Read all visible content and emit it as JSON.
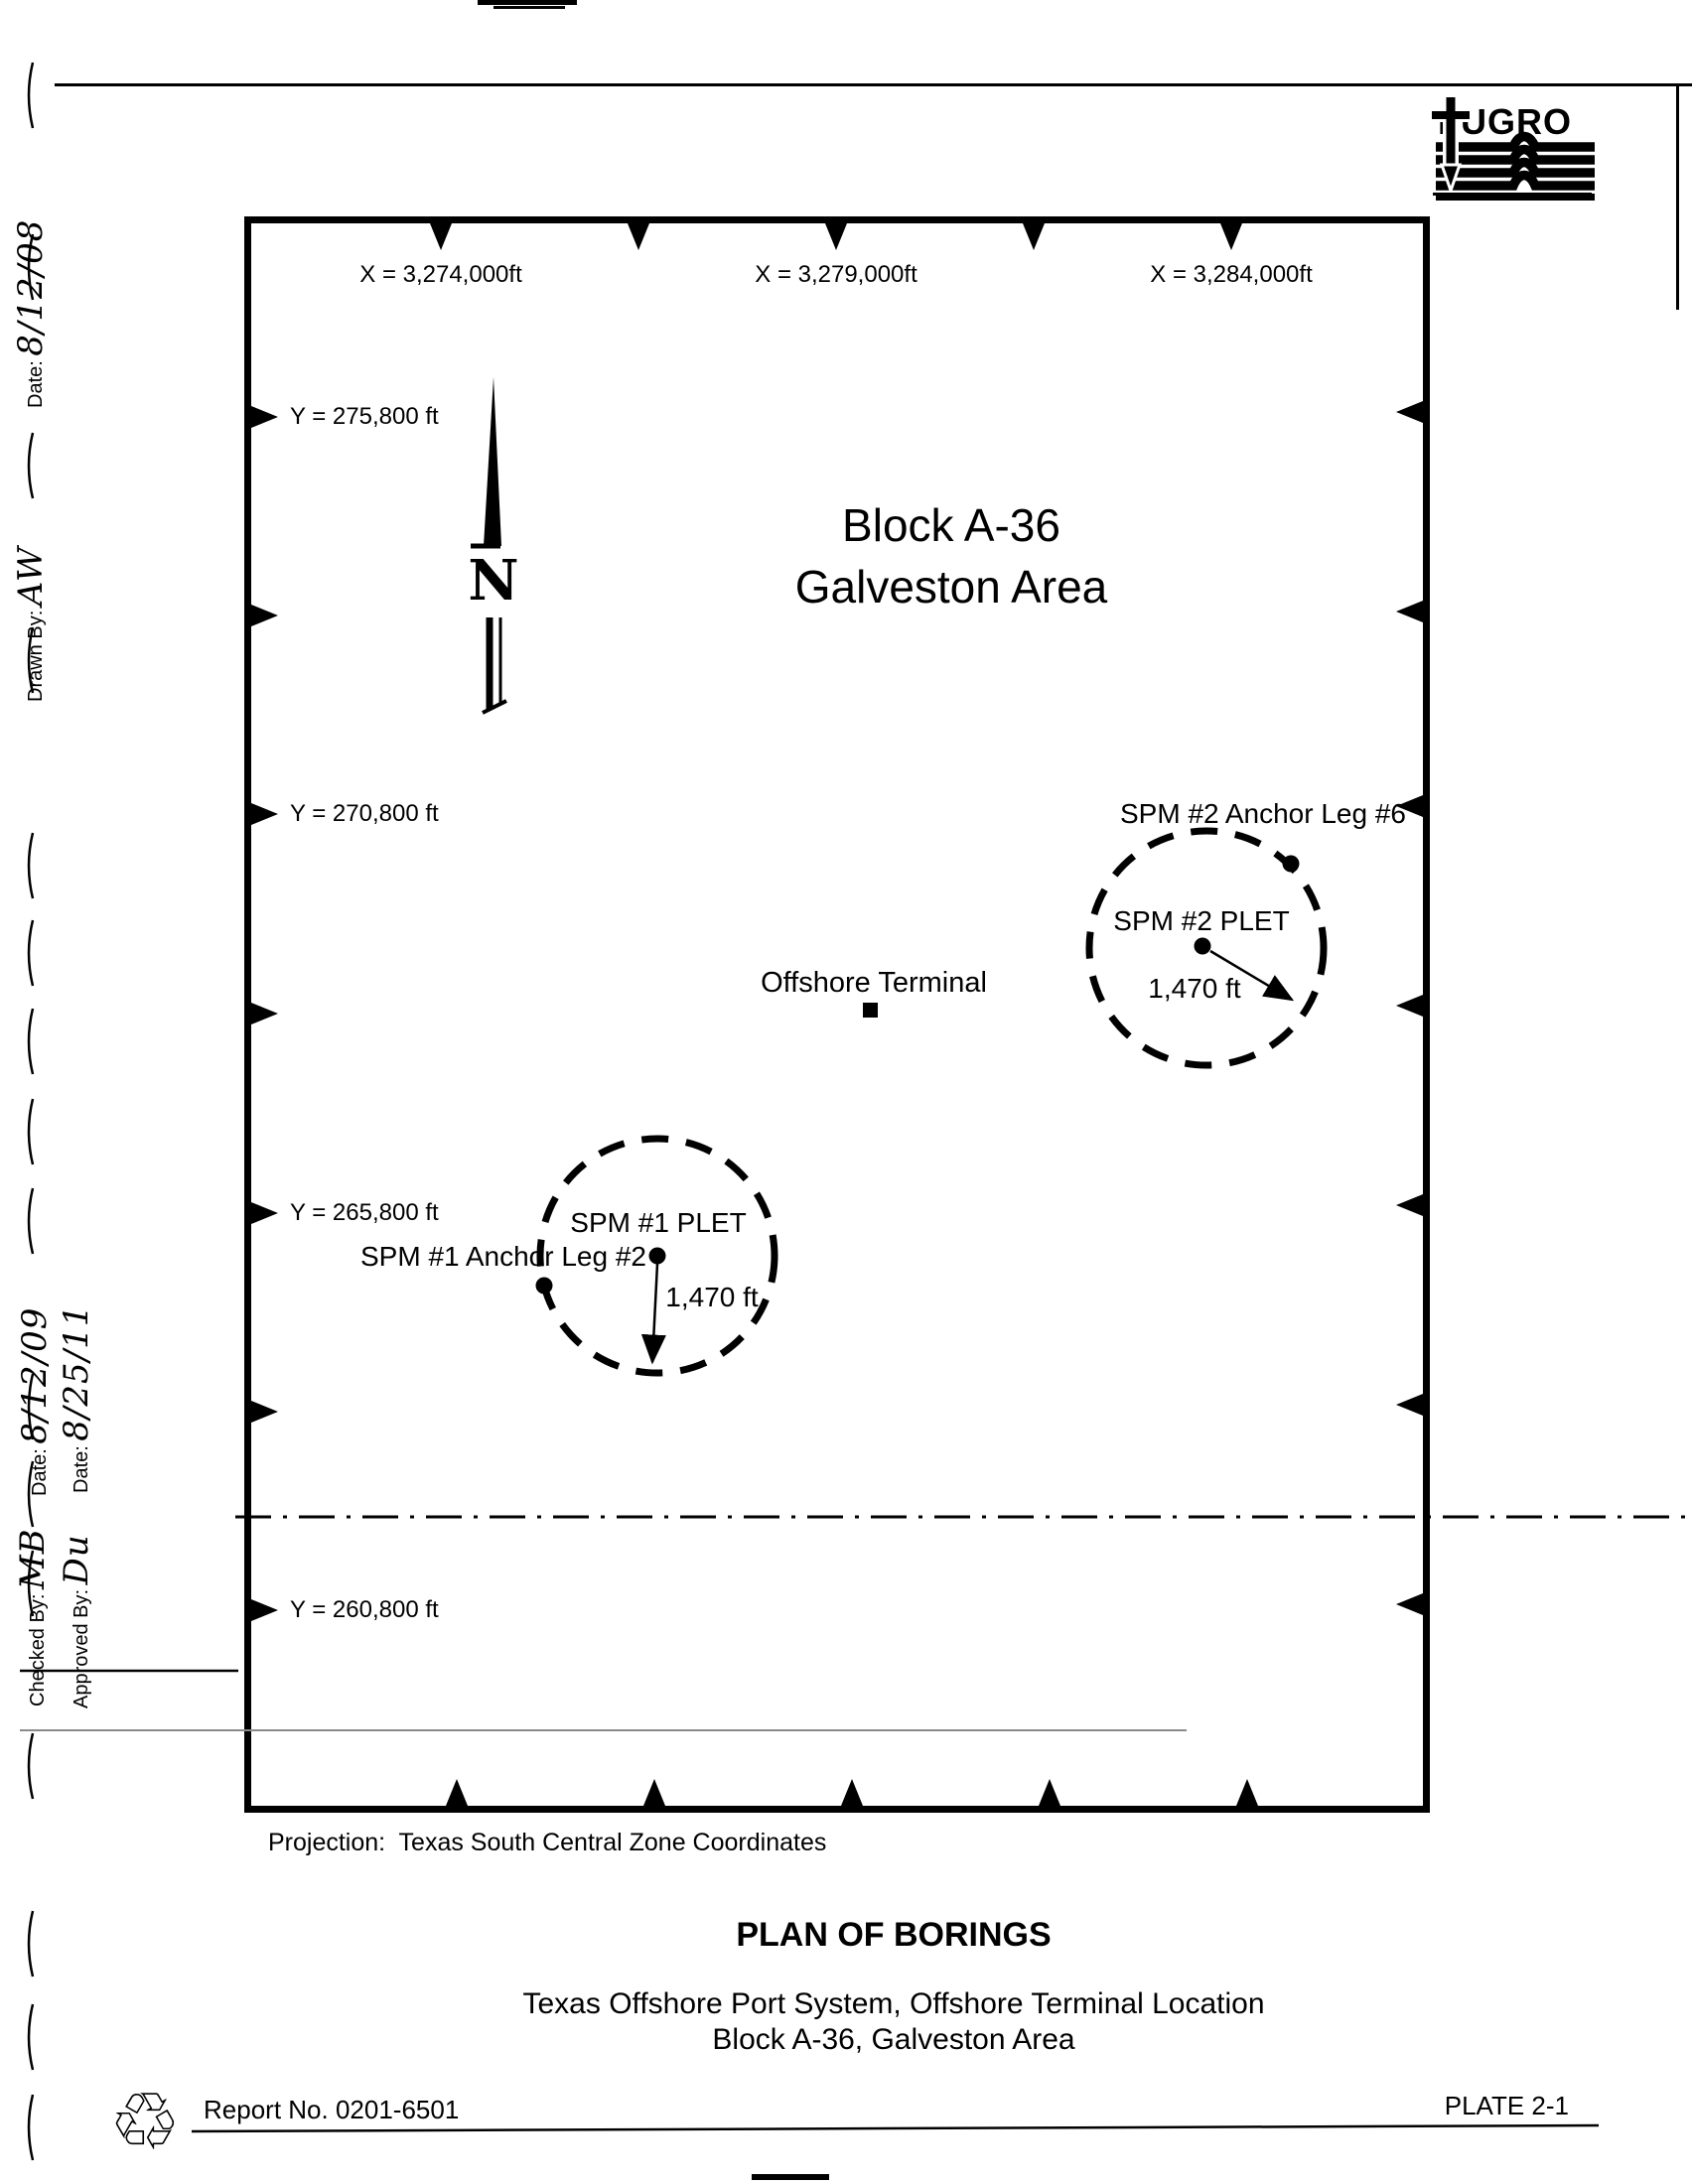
{
  "header": {
    "brand": "FUGRO"
  },
  "margin": {
    "entries": [
      {
        "label": "Date:",
        "value": "8/12/08"
      },
      {
        "label": "Drawn By:",
        "value": "AW"
      },
      {
        "label": "Date:",
        "value": "8/12/09"
      },
      {
        "label": "Date:",
        "value": "8/25/11"
      },
      {
        "label": "Checked By:",
        "value": "MB"
      },
      {
        "label": "Approved By:",
        "value": "Du"
      }
    ]
  },
  "map": {
    "block_title_line1": "Block A-36",
    "block_title_line2": "Galveston Area",
    "north_label": "N",
    "x_labels": [
      "X = 3,274,000ft",
      "X = 3,279,000ft",
      "X = 3,284,000ft"
    ],
    "y_labels": [
      "Y = 275,800 ft",
      "Y = 270,800 ft",
      "Y = 265,800 ft",
      "Y = 260,800 ft"
    ],
    "offshore_terminal_label": "Offshore Terminal",
    "spm2": {
      "anchor_label": "SPM #2 Anchor Leg #6",
      "plet_label": "SPM #2 PLET",
      "radius_label": "1,470 ft"
    },
    "spm1": {
      "anchor_label": "SPM #1 Anchor Leg #2",
      "plet_label": "SPM #1 PLET",
      "radius_label": "1,470 ft"
    }
  },
  "footer": {
    "projection": "Projection:  Texas South Central Zone Coordinates",
    "title": "PLAN OF BORINGS",
    "subtitle1": "Texas Offshore Port System, Offshore Terminal Location",
    "subtitle2": "Block A-36, Galveston Area",
    "report_no": "Report No. 0201-6501",
    "plate": "PLATE 2-1",
    "recycle_glyph": "♲"
  }
}
